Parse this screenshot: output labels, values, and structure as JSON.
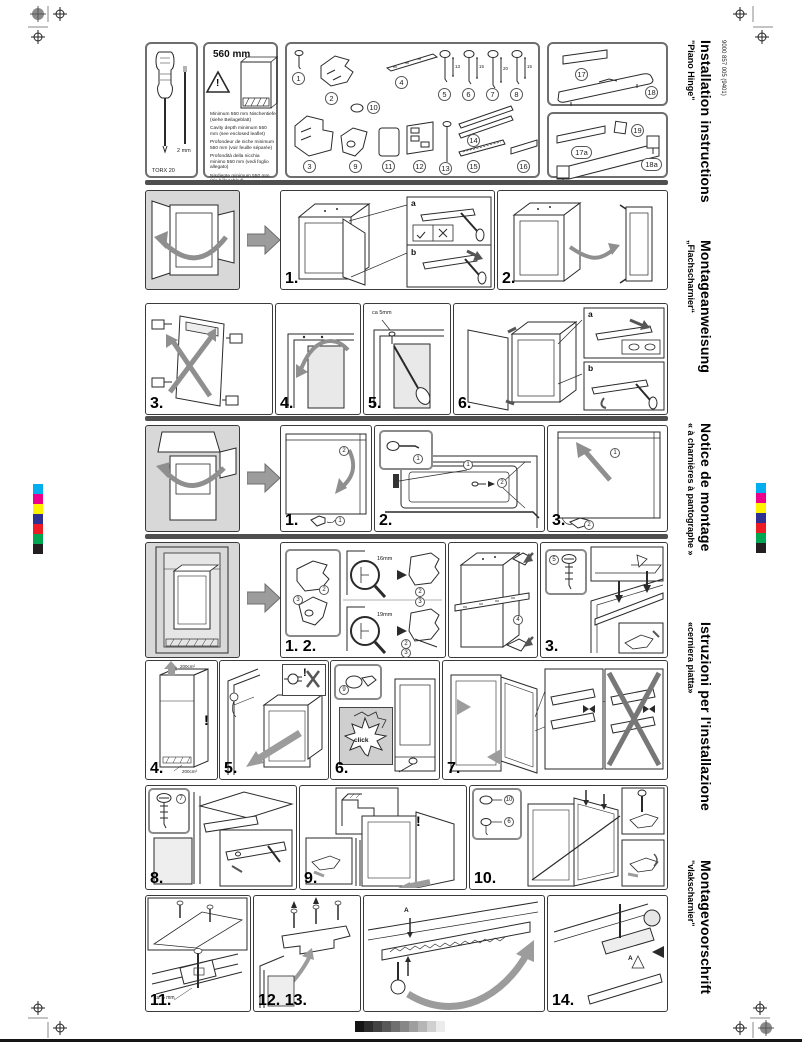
{
  "doc": {
    "number": "9000 857 005 (9401)"
  },
  "languages": [
    {
      "title": "Installation instructions",
      "subtitle": "\"Piano Hinge\""
    },
    {
      "title": "Montageanweisung",
      "subtitle": "„Flachscharnier“"
    },
    {
      "title": "Notice de montage",
      "subtitle": "« à charnières à pantographe »"
    },
    {
      "title": "Istruzioni per l'installazione",
      "subtitle": "«cerniera piatta»"
    },
    {
      "title": "Montagevoorschrift",
      "subtitle": "\"vlakscharnier\""
    }
  ],
  "tools": {
    "screwdriver_label": "TORX 20",
    "hex_label": "2 mm"
  },
  "cavity": {
    "headline": "560 mm",
    "notes": [
      "Minimum 550 mm Nischentiefe (siehe Beilageblatt)",
      "Cavity depth minimum 550 mm (see enclosed leaflet)",
      "Profondeur de niche minimum 550 mm (voir feuille séparée)",
      "Profondità della nicchia minimo 550 mm (vedi foglio allegato)",
      "Nisdiepte minimum 550 mm (zie bijlageblad)"
    ]
  },
  "parts": {
    "p1": "1",
    "p2": "2",
    "p3": "3",
    "p4": "4",
    "p5": "5",
    "p6": "6",
    "p7": "7",
    "p8": "8",
    "p9": "9",
    "p10": "10",
    "p11": "11",
    "p12": "12",
    "p13": "13",
    "p14": "14",
    "p15": "15",
    "p16": "16",
    "p17": "17",
    "p18": "18",
    "p17a": "17a",
    "p19": "19",
    "p18a": "18a",
    "dim5": "13",
    "dim6": "15",
    "dim7": "20",
    "dim8": "15"
  },
  "steps": {
    "n1": "1.",
    "n2": "2.",
    "n3": "3.",
    "n4": "4.",
    "n5": "5.",
    "n6": "6.",
    "n7": "7.",
    "n8": "8.",
    "n9": "9.",
    "n10": "10.",
    "n11": "11.",
    "n12_13": "12. 13.",
    "n14": "14.",
    "n1_2": "1. 2."
  },
  "callouts": {
    "a": "a",
    "b": "b",
    "ca5mm": "ca 5mm",
    "ca5mm_dot": "ca. 5 mm",
    "mm16": "16mm",
    "mm19": "19mm",
    "cm200": "200cm²",
    "excl": "!",
    "click": "click",
    "letterA": "A",
    "c1": "1",
    "c2": "2"
  },
  "print": {
    "color_bar": [
      "#00aeef",
      "#ec008c",
      "#fff200",
      "#2e3192",
      "#ed1c24",
      "#00a651",
      "#231f20"
    ],
    "gray_bar": [
      "#141414",
      "#2b2b2b",
      "#424242",
      "#595959",
      "#707070",
      "#878787",
      "#9e9e9e",
      "#b5b5b5",
      "#d0d0d0",
      "#ececec"
    ]
  }
}
